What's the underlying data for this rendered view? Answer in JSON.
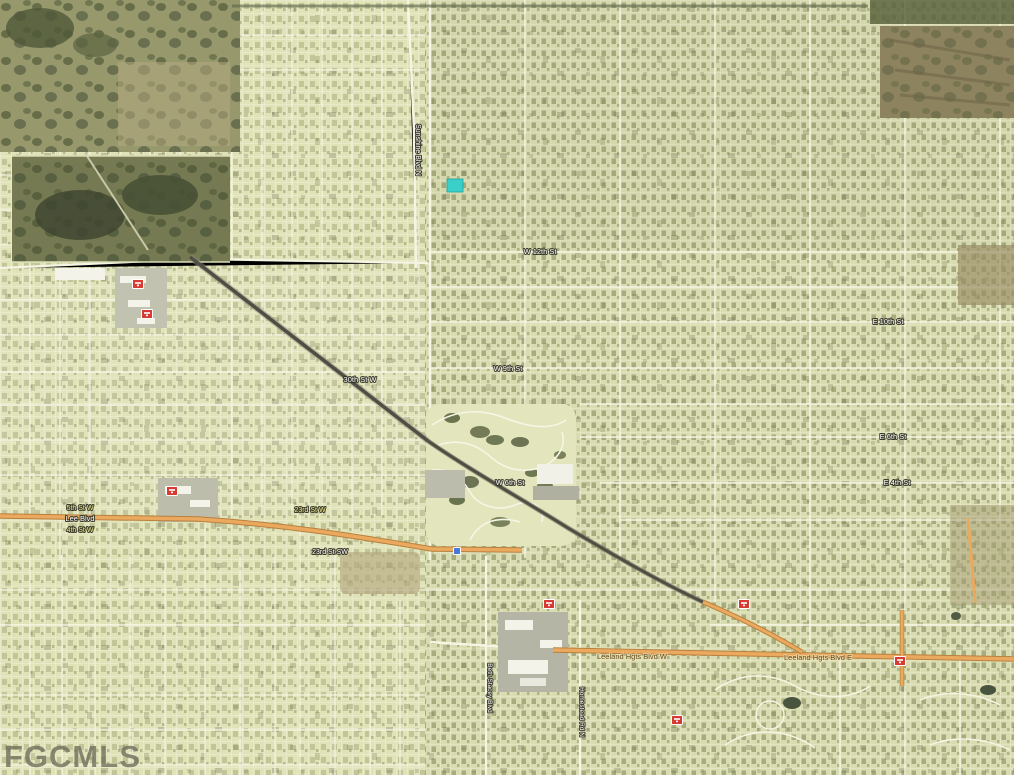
{
  "watermark": {
    "text": "FGCMLS"
  },
  "map": {
    "type": "satellite-aerial",
    "marker": {
      "x": 447,
      "y": 179,
      "width": 16,
      "height": 13,
      "color": "#3ad0c9",
      "label": "subject-property"
    },
    "palette": {
      "poi_red": "#d63a30",
      "poi_blue": "#4a79d8",
      "road_orange": "#eaa95e",
      "road_white": "#f4f5e2",
      "marker_teal": "#3ad0c9",
      "water_dark": "#49543f"
    },
    "labels": [
      {
        "text": "Sunshine Blvd N",
        "x": 416,
        "y": 150,
        "rotate": 90,
        "color": "#ffffff",
        "size": 7
      },
      {
        "text": "W 12th St",
        "x": 540,
        "y": 254,
        "color": "#ffffff",
        "size": 7.5
      },
      {
        "text": "W 9th St",
        "x": 508,
        "y": 371,
        "color": "#ffffff",
        "size": 7.5
      },
      {
        "text": "W 6th St",
        "x": 510,
        "y": 485,
        "color": "#ffffff",
        "size": 7.5
      },
      {
        "text": "E 10th St",
        "x": 888,
        "y": 324,
        "color": "#ffffff",
        "size": 7.5
      },
      {
        "text": "E 6th St",
        "x": 893,
        "y": 439,
        "color": "#ffffff",
        "size": 7.5
      },
      {
        "text": "E 4th St",
        "x": 897,
        "y": 485,
        "color": "#ffffff",
        "size": 7.5
      },
      {
        "text": "30th St W",
        "x": 360,
        "y": 382,
        "color": "#ffffff",
        "size": 7.5
      },
      {
        "text": "23rd St W",
        "x": 310,
        "y": 512,
        "color": "#f2ec85",
        "size": 7
      },
      {
        "text": "5th St W",
        "x": 80,
        "y": 510,
        "color": "#f2ec85",
        "size": 7
      },
      {
        "text": "Lee Blvd",
        "x": 80,
        "y": 521,
        "color": "#ffffff",
        "size": 7.5
      },
      {
        "text": "4th St W",
        "x": 80,
        "y": 532,
        "color": "#f2ec85",
        "size": 7
      },
      {
        "text": "23rd St SW",
        "x": 330,
        "y": 554,
        "color": "#ffffff",
        "size": 7
      },
      {
        "text": "Leeland Hgts Blvd W",
        "x": 632,
        "y": 659,
        "color": "#5e4b20",
        "size": 7.5
      },
      {
        "text": "Leeland Hgts Blvd E",
        "x": 818,
        "y": 660,
        "color": "#5e4b20",
        "size": 7.5
      },
      {
        "text": "Beth Stacey Blvd",
        "x": 488,
        "y": 688,
        "rotate": 90,
        "color": "#ffffff",
        "size": 6.5
      },
      {
        "text": "Homestead Rd N",
        "x": 580,
        "y": 712,
        "rotate": 90,
        "color": "#ffffff",
        "size": 6.5
      }
    ],
    "pois": [
      {
        "x": 138,
        "y": 284,
        "type": "red"
      },
      {
        "x": 147,
        "y": 314,
        "type": "red"
      },
      {
        "x": 172,
        "y": 491,
        "type": "red"
      },
      {
        "x": 549,
        "y": 604,
        "type": "red"
      },
      {
        "x": 744,
        "y": 604,
        "type": "red"
      },
      {
        "x": 677,
        "y": 720,
        "type": "red"
      },
      {
        "x": 900,
        "y": 661,
        "type": "red"
      },
      {
        "x": 457,
        "y": 551,
        "type": "blue"
      }
    ]
  }
}
